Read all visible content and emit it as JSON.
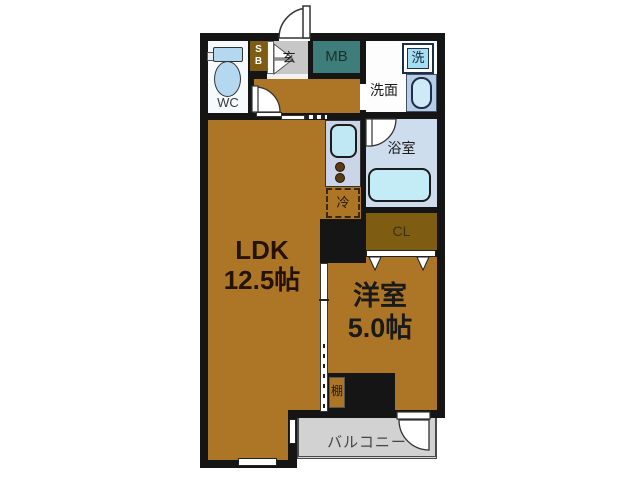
{
  "floor_plan": {
    "type": "apartment-floorplan",
    "rooms": {
      "ldk": {
        "name": "LDK",
        "area": "12.5帖"
      },
      "bedroom": {
        "name": "洋室",
        "area": "5.0帖"
      },
      "wc": {
        "name": "WC"
      },
      "entrance": {
        "name": "玄"
      },
      "shoe_box": {
        "line1": "S",
        "line2": "B"
      },
      "meter_box": {
        "name": "MB"
      },
      "washroom": {
        "name": "洗面"
      },
      "washing_machine": {
        "name": "洗"
      },
      "bathroom": {
        "name": "浴室"
      },
      "closet": {
        "name": "CL"
      },
      "fridge_space": {
        "name": "冷"
      },
      "shelf": {
        "name": "棚"
      },
      "balcony": {
        "name": "バルコニー"
      }
    },
    "icons": [
      "toilet-icon",
      "bathtub-icon",
      "washing-machine-icon",
      "sink-icon",
      "kitchen-sink-icon",
      "stove-burners-icon",
      "door-swing-icon",
      "sliding-door-icon",
      "folding-door-icon",
      "window-icon"
    ],
    "palette": {
      "wall": "#151515",
      "floor_brown": "#ad7627",
      "dark_gold": "#7e5c11",
      "entrance_gray": "#c7c7c7",
      "meter_box_teal": "#3f7d7a",
      "bath_floor": "#cedded",
      "tub_cyan": "#c3ecf6",
      "kitchen_counter": "#cbd5e9",
      "washer_blue": "#a6def1",
      "counter_blue": "#b6cde5",
      "toilet_blue": "#b4d8f0",
      "balcony_gray": "#d2d2d2",
      "background": "#ffffff"
    }
  }
}
